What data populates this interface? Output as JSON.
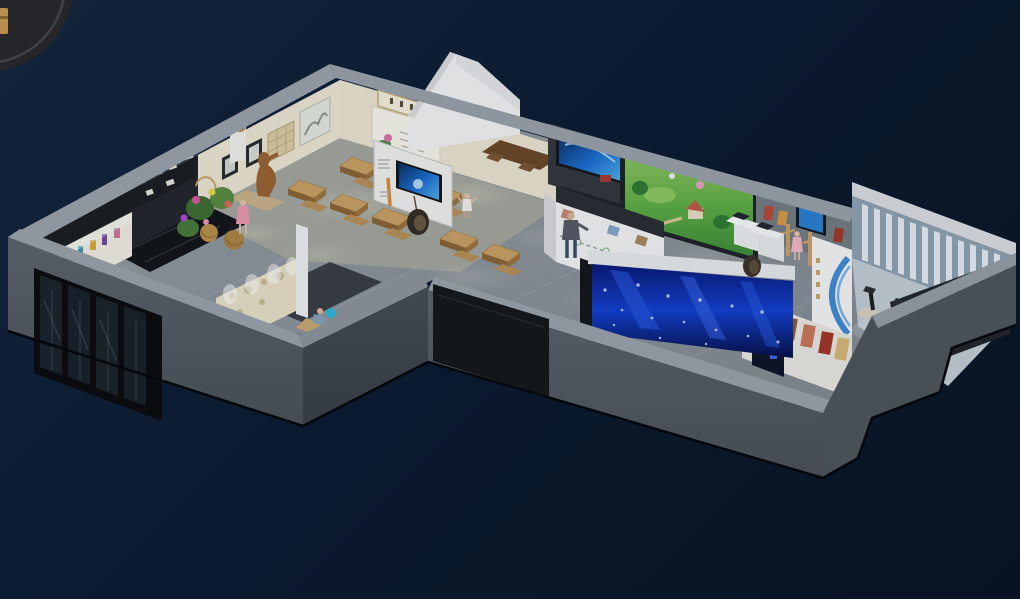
{
  "scene": {
    "title": "3D isometric cutaway rendering of a museum exhibition hall floor plan on a dark navy background",
    "background": {
      "gradient_top": "#15263f",
      "gradient_mid": "#0d1c31",
      "gradient_bottom": "#081424"
    },
    "corner_badge": {
      "shape": "partial dark circle with gold emblem",
      "fill": "#28292c",
      "ring": "#45484d",
      "emblem": "#c79a52"
    },
    "palette": {
      "outer_wall_top": "#9ba3ac",
      "outer_wall_face": "#565d66",
      "outer_wall_shadow_face": "#3f454d",
      "cream_wall": "#ece5d3",
      "corridor_floor": "#8d949c",
      "tea_room_floor": "#a3a79e",
      "lobby_floor": "#c2ccd5",
      "media_screen_blue": "#1d6fd2",
      "projection_green": "#5fae46",
      "led_wall_blue": "#1440d0",
      "logo_ring_blue": "#2f7fd1",
      "wood_table": "#c8a064",
      "bronze_statue": "#9a6434"
    },
    "areas": [
      {
        "id": "tea-classroom",
        "label": "heritage teaching room with wooden desks, benches and calligraphy sign board"
      },
      {
        "id": "entrance-artifact-wall",
        "label": "dark display wall with white artifact silhouettes and lit showcase"
      },
      {
        "id": "flower-display",
        "label": "plants, flowers and woven baskets corner"
      },
      {
        "id": "bronze-statue",
        "label": "standing bronze figure on plinth"
      },
      {
        "id": "corridor-display-wall",
        "label": "white exhibit wall with blue video screen and hanging egg chair"
      },
      {
        "id": "media-wall",
        "label": "dark media wall with blue TV and backlit artifact shelves"
      },
      {
        "id": "projection-screen",
        "label": "large green cartoon village projection screen"
      },
      {
        "id": "right-exhibit-wall",
        "label": "grey wall with posters, showcase screen and wooden stands"
      },
      {
        "id": "timeline-island",
        "label": "white interactive timeline island with visitor"
      },
      {
        "id": "led-aquarium-wall",
        "label": "large deep-blue LED water screen"
      },
      {
        "id": "poster-wall",
        "label": "white wall with colorful figure posters"
      },
      {
        "id": "logo-curve-wall",
        "label": "curved white wall with blue ring logo graphic"
      },
      {
        "id": "entry-lobby",
        "label": "lobby with vertical louver window wall, turnstiles and dark ramp"
      },
      {
        "id": "glass-entrance",
        "label": "black framed glass entrance doors"
      },
      {
        "id": "external-screen",
        "label": "dark display panel mounted on outer wall"
      }
    ],
    "people_count": 6
  }
}
